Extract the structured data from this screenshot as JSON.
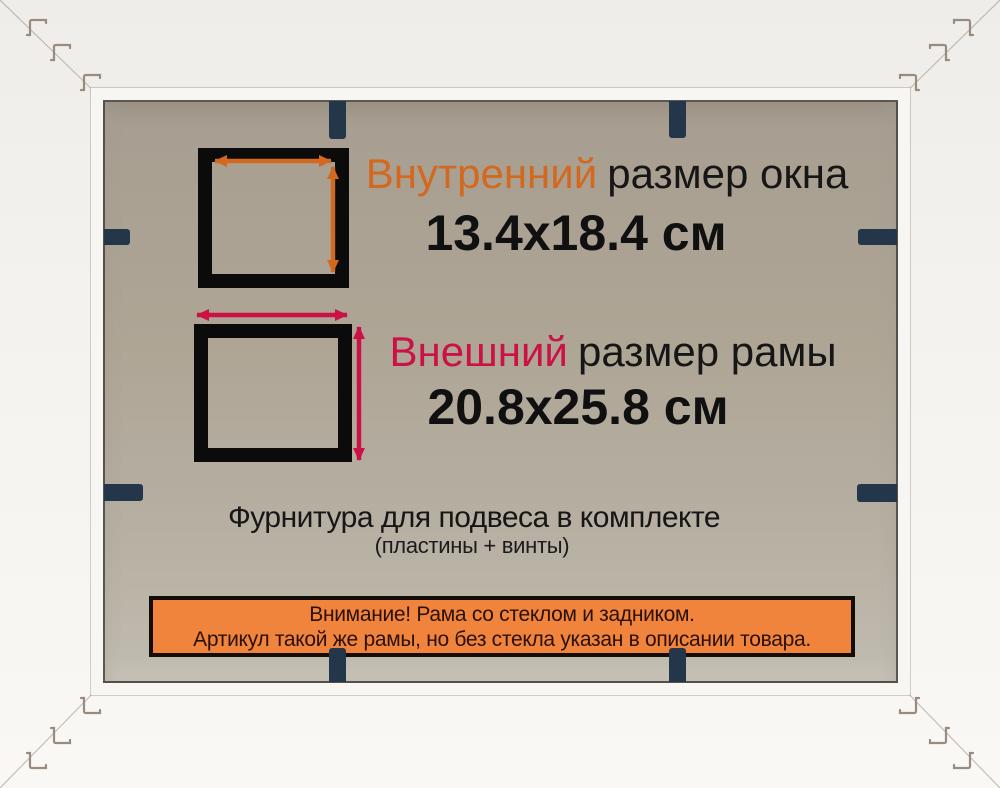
{
  "product_card": {
    "inner_size": {
      "label_highlight": "Внутренний",
      "label_rest": "размер окна",
      "value": "13.4x18.4 см"
    },
    "outer_size": {
      "label_highlight": "Внешний",
      "label_rest": "размер рамы",
      "value": "20.8x25.8 см"
    },
    "hardware_note": {
      "title": "Фурнитура для подвеса в комплекте",
      "subtitle": "(пластины + винты)"
    },
    "notice_banner": {
      "line1": "Внимание! Рама со стеклом и задником.",
      "line2": "Артикул такой же рамы, но без стекла указан в описании товара."
    },
    "colors": {
      "inner_accent": "#d2691e",
      "outer_accent": "#cb1146",
      "banner_bg": "#f0843c",
      "banner_border": "#140c06",
      "banner_text": "#2a1007",
      "staple_navy": "#24374a",
      "square_black": "#0b0b0b",
      "backing_grey": "#aca395",
      "frame_white": "#f5f3ef"
    },
    "icons": {
      "width_arrow": "double-headed-horizontal-arrow",
      "height_arrow": "double-headed-vertical-arrow",
      "corner_staple": "v-nail-mark",
      "backing_tab": "flexi-point-clip"
    }
  }
}
